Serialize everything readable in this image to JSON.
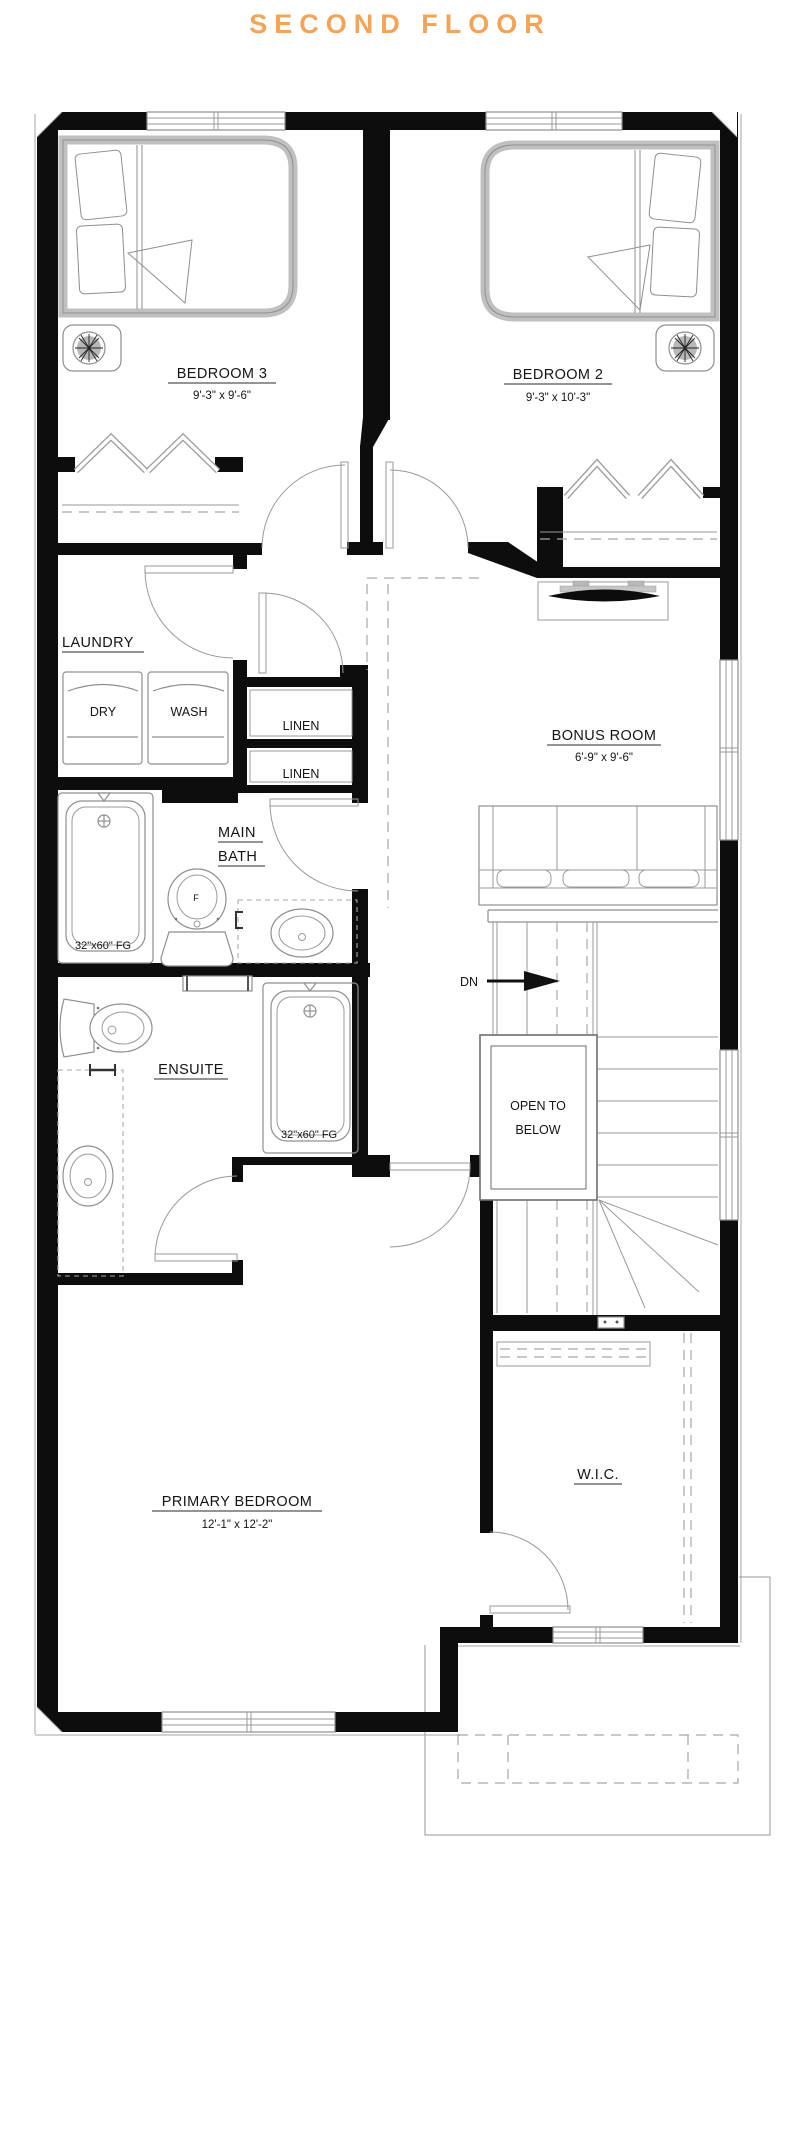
{
  "title": {
    "text": "SECOND FLOOR",
    "color": "#F5A455"
  },
  "rooms": {
    "bedroom3": {
      "name": "BEDROOM 3",
      "dims": "9'-3\" x 9'-6\""
    },
    "bedroom2": {
      "name": "BEDROOM 2",
      "dims": "9'-3\" x 10'-3\""
    },
    "laundry": {
      "name": "LAUNDRY"
    },
    "bonus_room": {
      "name": "BONUS ROOM",
      "dims": "6'-9\" x 9'-6\""
    },
    "main_bath": {
      "name_line1": "MAIN",
      "name_line2": "BATH"
    },
    "ensuite": {
      "name": "ENSUITE"
    },
    "primary_bedroom": {
      "name": "PRIMARY BEDROOM",
      "dims": "12'-1\" x 12'-2\""
    },
    "wic": {
      "name": "W.I.C."
    }
  },
  "labels": {
    "dryer": "DRY",
    "washer": "WASH",
    "linen1": "LINEN",
    "linen2": "LINEN",
    "stairs_down": "DN",
    "open_below_line1": "OPEN TO",
    "open_below_line2": "BELOW",
    "tub_main": "32\"x60\" FG",
    "tub_ensuite": "32\"x60\" FG",
    "toilet_symbol": "F"
  },
  "colors": {
    "accent": "#F5A455",
    "wall": "#0d0d0d",
    "line": "#8f8f8f"
  }
}
